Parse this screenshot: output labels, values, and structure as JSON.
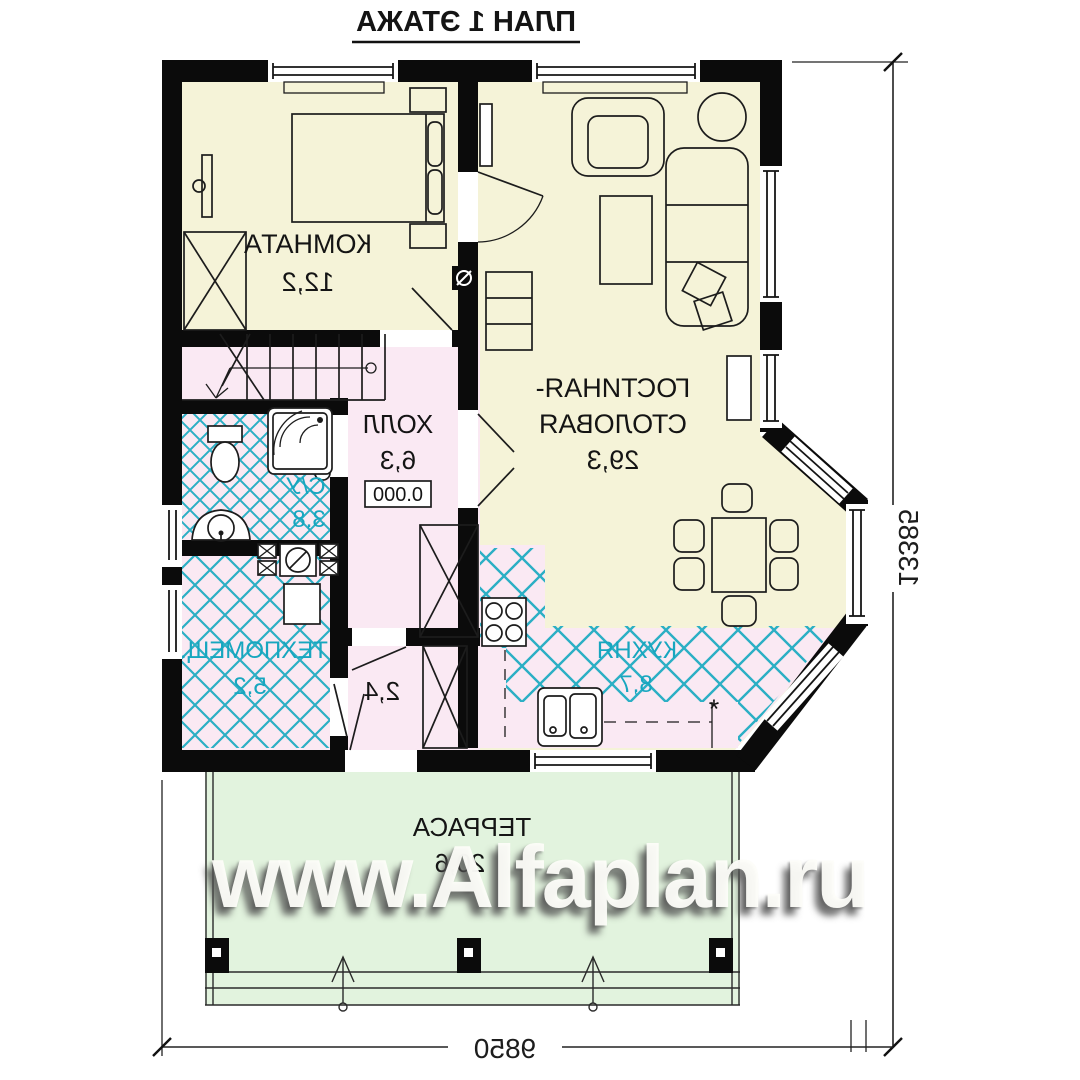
{
  "title": "ПЛАН 1 ЭТАЖА",
  "rooms": {
    "bedroom": {
      "name": "КОМНАТА",
      "area": "12,2"
    },
    "living": {
      "name_line1": "ГОСТИНАЯ-",
      "name_line2": "СТОЛОВАЯ",
      "area": "29,3"
    },
    "hall": {
      "name": "ХОЛЛ",
      "area": "6,3",
      "level_mark": "0.000"
    },
    "bathroom": {
      "name": "С/У",
      "area": "3,8"
    },
    "tech_room": {
      "name": "ТЕХПОМЕЩ.",
      "area": "5,2"
    },
    "entry": {
      "area": "2,4"
    },
    "kitchen": {
      "name": "КУХНЯ",
      "area": "8,7",
      "note": "*"
    },
    "terrace": {
      "name": "ТЕРРАСА",
      "area": "20,6"
    }
  },
  "dimensions": {
    "overall_width_mm": "9850",
    "overall_depth_mm": "13385"
  },
  "watermark": "www.Alfaplan.ru",
  "colors": {
    "wall": "#0b0b0b",
    "room_cream": "#f5f3d8",
    "room_pink": "#fae9f3",
    "terrace_green": "#e2f3de",
    "tile_hatch_teal": "#2bafc4",
    "label_teal": "#17a6bf"
  }
}
